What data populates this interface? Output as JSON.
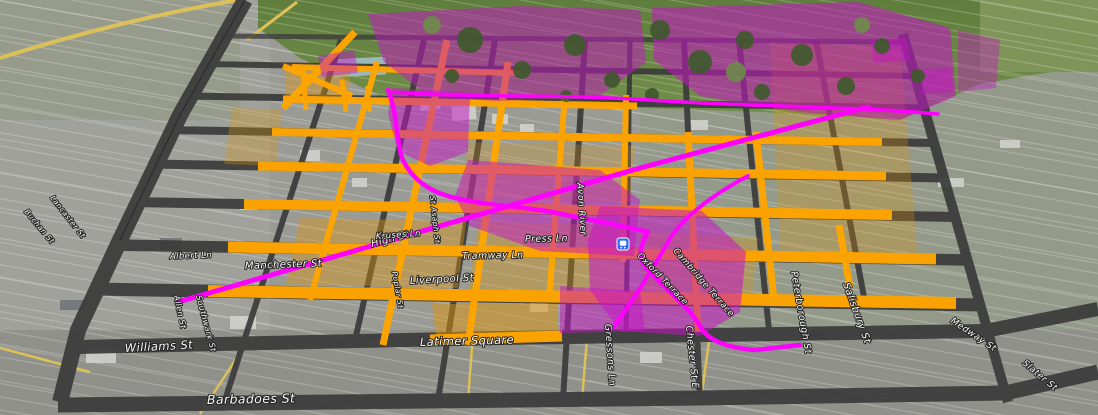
{
  "map": {
    "colors": {
      "grid_gray": "#3b3b3b",
      "highlight_orange": "#ffa600",
      "block_orange": "#de940a",
      "zone_magenta": "#c614c6",
      "route_magenta": "#ff00ff",
      "road_yellow": "#dcc158",
      "transit_blue": "#2e6cf0"
    },
    "icons": [
      {
        "name": "transit-station-icon"
      }
    ],
    "labels": [
      {
        "text": "Barbadoes St"
      },
      {
        "text": "Williams St"
      },
      {
        "text": "Latimer Square"
      },
      {
        "text": "Manchester St"
      },
      {
        "text": "Liverpool St"
      },
      {
        "text": "High St"
      },
      {
        "text": "Tramway Ln"
      },
      {
        "text": "Press Ln"
      },
      {
        "text": "Avon River"
      },
      {
        "text": "Cambridge Terrace"
      },
      {
        "text": "Oxford Terrace"
      },
      {
        "text": "Gressons Ln"
      },
      {
        "text": "Chester St E"
      },
      {
        "text": "Peterborough St"
      },
      {
        "text": "Salisbury St"
      },
      {
        "text": "Medway St"
      },
      {
        "text": "Slater St"
      },
      {
        "text": "St Asaph St"
      },
      {
        "text": "Kruses Ln"
      },
      {
        "text": "Albert Ln"
      },
      {
        "text": "Allen St"
      },
      {
        "text": "Southwark St"
      },
      {
        "text": "Buchan St"
      },
      {
        "text": "Lancaster St"
      },
      {
        "text": "Poplar St"
      }
    ]
  }
}
